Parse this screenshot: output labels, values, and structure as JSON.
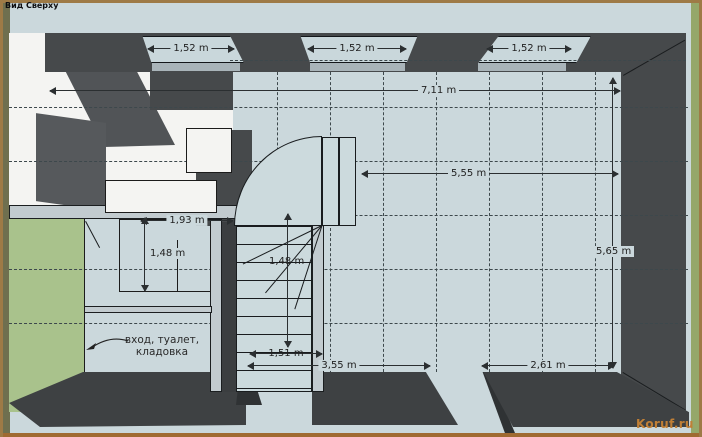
{
  "view_label": "Вид Сверху",
  "watermark": "Koruf.ru",
  "room_note": {
    "line1": "вход, туалет,",
    "line2": "кладовка"
  },
  "dimensions": {
    "window_left": "1,52 m",
    "window_center": "1,52 m",
    "window_right": "1,52 m",
    "overall_width": "7,11 m",
    "main_room_width": "5,55 m",
    "main_room_depth": "5,65 m",
    "closet_width": "1,93 m",
    "closet_depth": "1,48 m",
    "stair_flight": "1,48 m",
    "stair_width": "1,51 m",
    "bottom_left_span": "3,55 m",
    "bottom_right_span": "2,61 m"
  },
  "colors": {
    "frame": "#9e7a46",
    "floor": "#cbd8dc",
    "wall_dark": "#46494b",
    "grass": "#a9c28c",
    "stairs": "#ccdadd",
    "watermark": "#c07f36"
  }
}
